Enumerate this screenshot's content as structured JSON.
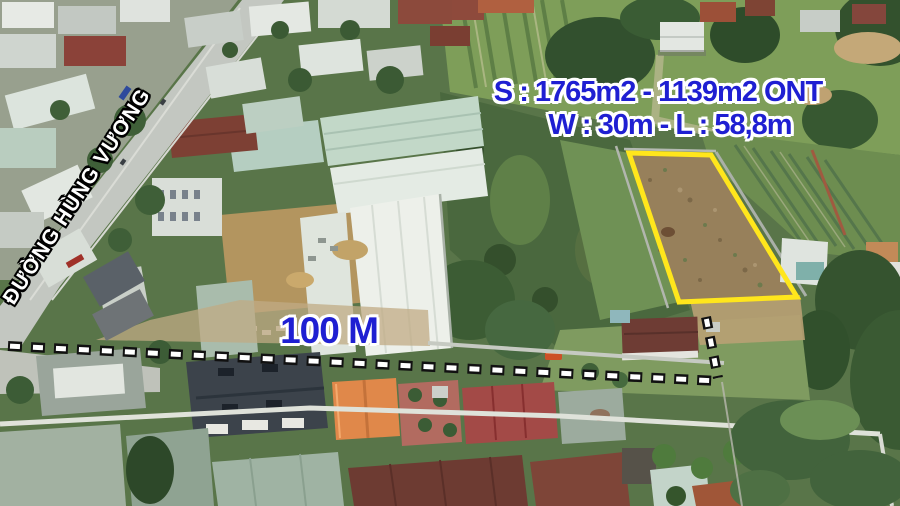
{
  "overlay": {
    "area_label": "S : 1765m2 - 1139m2 ONT",
    "size_label": "W : 30m - L : 58,8m",
    "distance_label": "100 M",
    "street_label": "ĐƯỜNG HÙNG VƯƠNG",
    "colors": {
      "label_blue": "#1f1fd2",
      "label_outline": "#ffffff",
      "plot_outline_yellow": "#ffe61c",
      "street_text_white": "#ffffff",
      "street_text_outline": "#000000",
      "dash_white": "#ffffff",
      "dash_outline": "#111111"
    }
  }
}
